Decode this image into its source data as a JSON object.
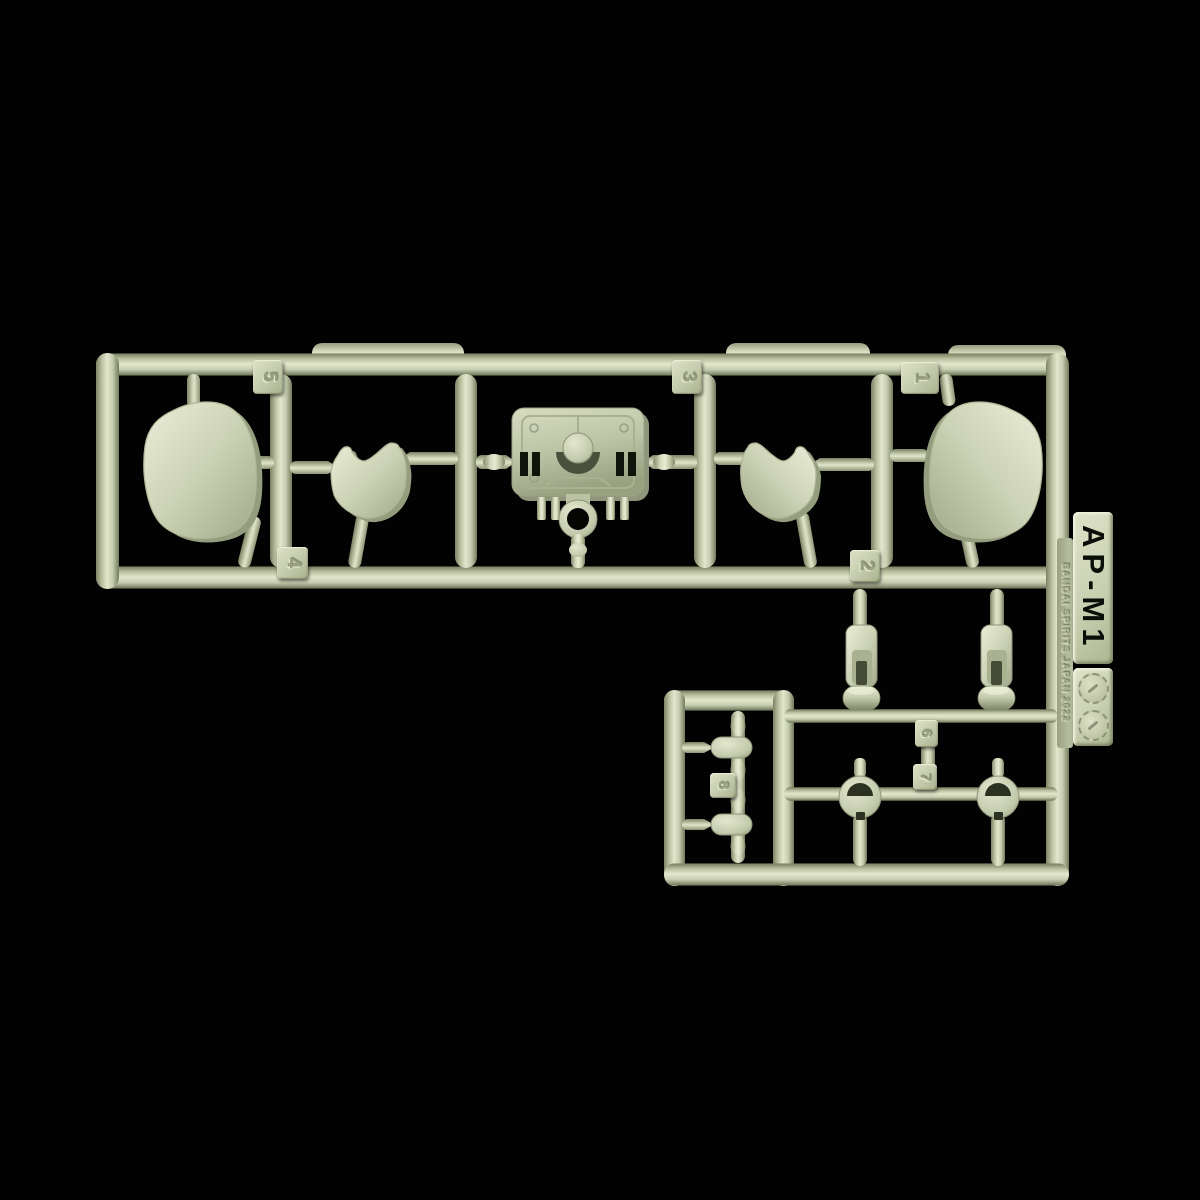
{
  "sprue": {
    "tag": {
      "code": "AP-M1",
      "maker_line": "BANDAI SPIRITS JAPAN 2022"
    },
    "part_labels": [
      "1",
      "2",
      "3",
      "4",
      "5",
      "6",
      "7",
      "8"
    ],
    "colors": {
      "plastic_base": "#c8cfb2",
      "plastic_highlight": "#e6ead2",
      "plastic_shadow": "#7c8363",
      "background": "#000000"
    }
  }
}
